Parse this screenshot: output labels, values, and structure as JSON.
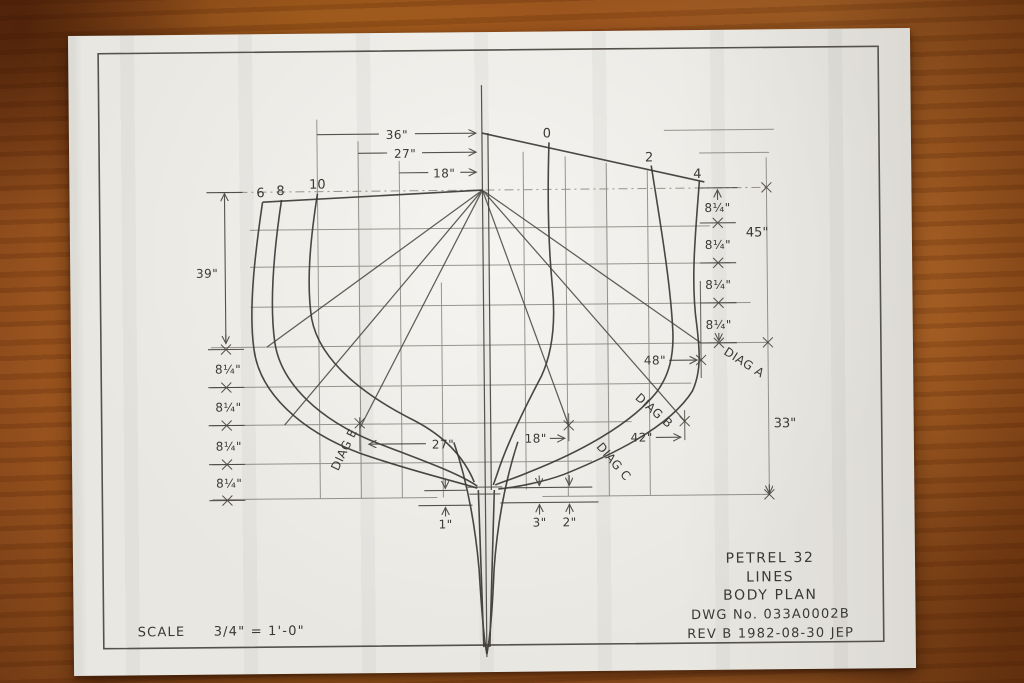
{
  "colors": {
    "wood": "#a85c20",
    "paper": "#e9e7e1",
    "ink": "#3b3933"
  },
  "drawing": {
    "stations": {
      "s0": "0",
      "s2": "2",
      "s4": "4",
      "s6": "6",
      "s8": "8",
      "s10": "10"
    },
    "top_dims": {
      "d36": "36\"",
      "d27": "27\"",
      "d18": "18\""
    },
    "left_dims": {
      "total": "39\"",
      "step": "8¼\""
    },
    "right_dims": {
      "step": "8¼\"",
      "d45": "45\"",
      "d33": "33\"",
      "d48": "48\"",
      "d42": "42\"",
      "d18": "18\"",
      "d27": "27\""
    },
    "bottom_dims": {
      "d1": "1\"",
      "d3": "3\"",
      "d2": "2\""
    },
    "diagonals": {
      "a": "DIAG A",
      "b": "DIAG B",
      "c": "DIAG C",
      "e": "DIAG E"
    },
    "title_block": {
      "product": "PETREL 32",
      "sheet": "LINES",
      "view": "BODY PLAN",
      "dwg_no": "DWG No. 033A0002B",
      "rev": "REV B 1982-08-30 JEP"
    },
    "scale": {
      "label": "SCALE",
      "value": "3/4\" = 1'-0\""
    }
  }
}
